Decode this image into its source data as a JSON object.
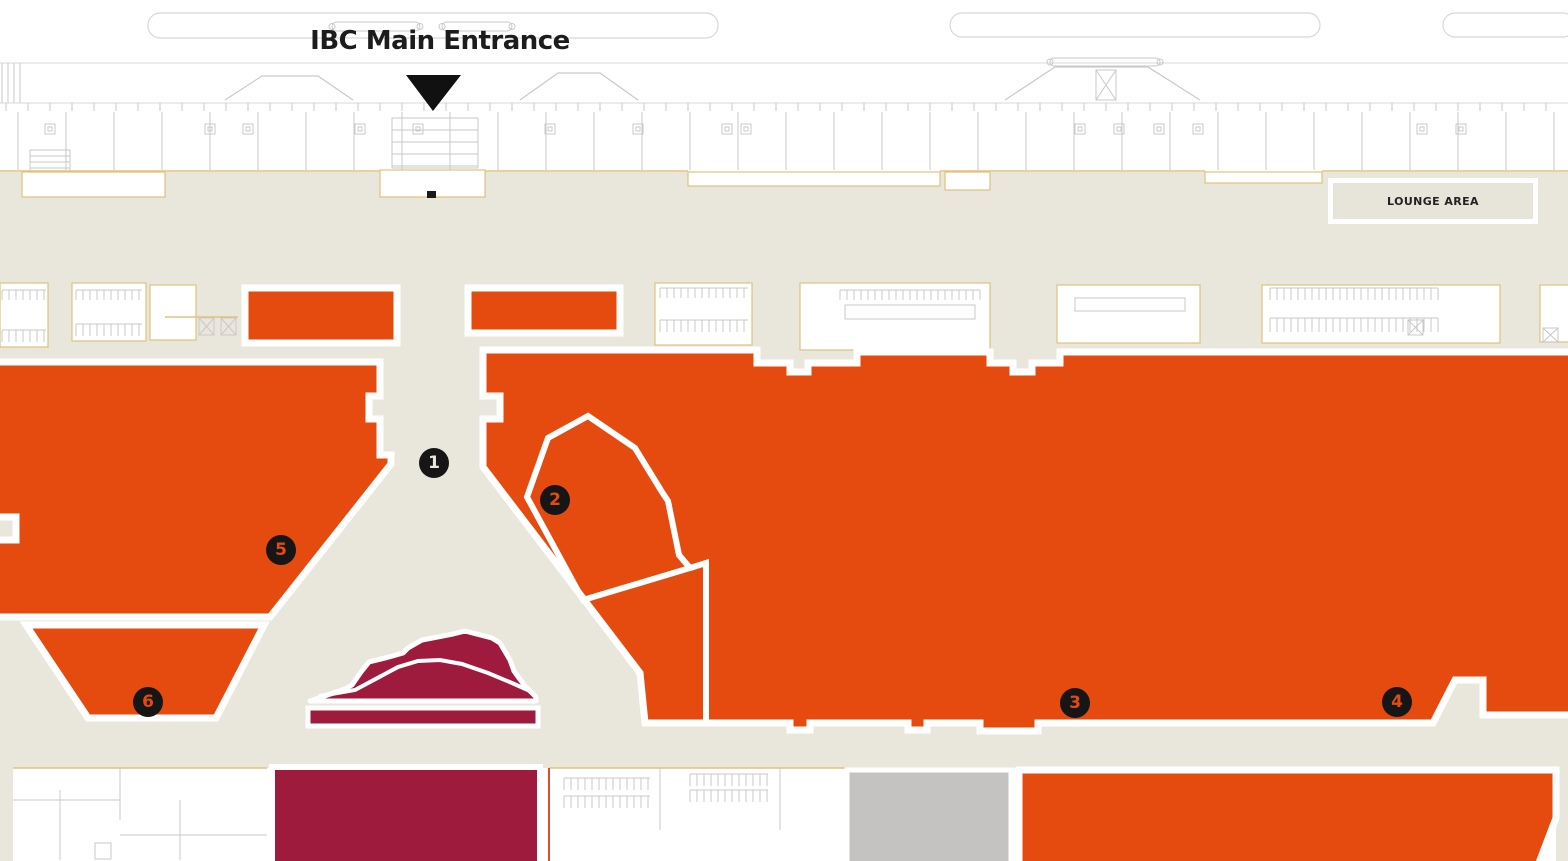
{
  "map": {
    "title_label": "IBC Main Entrance",
    "lounge_label": "LOUNGE AREA",
    "colors": {
      "beige": "#e9e7db",
      "orange": "#e54a0f",
      "maroon": "#9e1b3e",
      "gray": "#c4c3c1",
      "white": "#ffffff",
      "marker_bg": "#161616",
      "line": "#c9c9c9",
      "line_soft": "#d8d8d8",
      "yellow": "#dfc27d",
      "red_accent": "#d8502a",
      "text": "#1c1c1c"
    },
    "markers": [
      {
        "label": "1",
        "x": 434,
        "y": 463,
        "fg": "#e9e7db"
      },
      {
        "label": "2",
        "x": 555,
        "y": 500,
        "fg": "#e54a0f"
      },
      {
        "label": "3",
        "x": 1075,
        "y": 703,
        "fg": "#e54a0f"
      },
      {
        "label": "4",
        "x": 1397,
        "y": 702,
        "fg": "#e54a0f"
      },
      {
        "label": "5",
        "x": 281,
        "y": 550,
        "fg": "#e54a0f"
      },
      {
        "label": "6",
        "x": 148,
        "y": 702,
        "fg": "#e54a0f"
      }
    ],
    "entrance_arrow": {
      "points": [
        [
          406,
          75
        ],
        [
          461,
          75
        ],
        [
          433,
          111
        ]
      ]
    },
    "base": {
      "beige_rect": [
        0,
        172,
        1568,
        696
      ],
      "bottom_white_rect": [
        13,
        768,
        1543,
        100
      ]
    },
    "orange_regions": [
      {
        "name": "booth-block-a",
        "points": [
          [
            245,
            288
          ],
          [
            397,
            288
          ],
          [
            397,
            343
          ],
          [
            245,
            343
          ]
        ]
      },
      {
        "name": "booth-block-b",
        "points": [
          [
            468,
            288
          ],
          [
            620,
            288
          ],
          [
            620,
            333
          ],
          [
            468,
            333
          ]
        ]
      },
      {
        "name": "zone-5",
        "points": [
          [
            -8,
            362
          ],
          [
            380,
            362
          ],
          [
            380,
            396
          ],
          [
            369,
            396
          ],
          [
            369,
            419
          ],
          [
            380,
            419
          ],
          [
            380,
            455
          ],
          [
            391,
            455
          ],
          [
            391,
            464
          ],
          [
            270,
            617
          ],
          [
            -8,
            617
          ],
          [
            -8,
            540
          ],
          [
            16,
            540
          ],
          [
            16,
            517
          ],
          [
            -8,
            517
          ]
        ]
      },
      {
        "name": "zone-6",
        "points": [
          [
            26,
            625
          ],
          [
            264,
            625
          ],
          [
            216,
            718
          ],
          [
            88,
            718
          ]
        ]
      },
      {
        "name": "main-hall",
        "points": [
          [
            483,
            350
          ],
          [
            757,
            350
          ],
          [
            757,
            363
          ],
          [
            790,
            363
          ],
          [
            790,
            372
          ],
          [
            808,
            372
          ],
          [
            808,
            363
          ],
          [
            857,
            363
          ],
          [
            857,
            352
          ],
          [
            990,
            352
          ],
          [
            990,
            363
          ],
          [
            1013,
            363
          ],
          [
            1013,
            372
          ],
          [
            1032,
            372
          ],
          [
            1032,
            363
          ],
          [
            1060,
            363
          ],
          [
            1060,
            352
          ],
          [
            1575,
            352
          ],
          [
            1575,
            715
          ],
          [
            1483,
            715
          ],
          [
            1483,
            680
          ],
          [
            1455,
            680
          ],
          [
            1433,
            723
          ],
          [
            1038,
            723
          ],
          [
            1038,
            731
          ],
          [
            980,
            731
          ],
          [
            980,
            723
          ],
          [
            927,
            723
          ],
          [
            927,
            730
          ],
          [
            908,
            730
          ],
          [
            908,
            723
          ],
          [
            810,
            723
          ],
          [
            810,
            730
          ],
          [
            790,
            730
          ],
          [
            790,
            723
          ],
          [
            645,
            723
          ],
          [
            640,
            673
          ],
          [
            483,
            467
          ],
          [
            483,
            419
          ],
          [
            500,
            419
          ],
          [
            500,
            396
          ],
          [
            483,
            396
          ]
        ]
      },
      {
        "name": "south-hall",
        "points": [
          [
            1019,
            770
          ],
          [
            1556,
            770
          ],
          [
            1556,
            818
          ],
          [
            1537,
            868
          ],
          [
            1019,
            868
          ]
        ]
      }
    ],
    "white_division_lines": [
      {
        "name": "zone-2-outline",
        "closed": true,
        "points": [
          [
            588,
            416
          ],
          [
            635,
            448
          ],
          [
            662,
            492
          ],
          [
            668,
            501
          ],
          [
            679,
            555
          ],
          [
            690,
            568
          ],
          [
            583,
            600
          ],
          [
            527,
            497
          ],
          [
            548,
            438
          ]
        ]
      },
      {
        "name": "hall-divider",
        "closed": false,
        "points": [
          [
            690,
            568
          ],
          [
            706,
            563
          ],
          [
            706,
            723
          ]
        ]
      }
    ],
    "maroon": {
      "mountain": [
        [
          310,
          701
        ],
        [
          345,
          689
        ],
        [
          352,
          685
        ],
        [
          361,
          672
        ],
        [
          369,
          662
        ],
        [
          389,
          657
        ],
        [
          403,
          653
        ],
        [
          408,
          648
        ],
        [
          422,
          640
        ],
        [
          453,
          634
        ],
        [
          465,
          631
        ],
        [
          492,
          638
        ],
        [
          500,
          643
        ],
        [
          510,
          660
        ],
        [
          514,
          671
        ],
        [
          519,
          678
        ],
        [
          525,
          686
        ],
        [
          536,
          697
        ],
        [
          536,
          701
        ]
      ],
      "ridge": [
        [
          320,
          696
        ],
        [
          355,
          690
        ],
        [
          398,
          667
        ],
        [
          418,
          661
        ],
        [
          440,
          660
        ],
        [
          462,
          664
        ],
        [
          488,
          673
        ],
        [
          512,
          683
        ],
        [
          530,
          691
        ]
      ],
      "bar": [
        308,
        708,
        230,
        18
      ],
      "south_block": [
        272,
        767,
        268,
        101
      ]
    },
    "gray_block": [
      847,
      770,
      164,
      98
    ],
    "top_band": {
      "hlines": [
        [
          0,
          63,
          1568,
          63
        ],
        [
          0,
          103,
          1568,
          103
        ]
      ],
      "rounded_rects": [
        [
          148,
          13,
          570,
          25
        ],
        [
          950,
          13,
          370,
          24
        ],
        [
          1443,
          13,
          132,
          24
        ]
      ],
      "capsules": [
        [
          332,
          22,
          88,
          9
        ],
        [
          442,
          22,
          70,
          9
        ],
        [
          1050,
          58,
          110,
          8
        ]
      ],
      "mounds": [
        [
          [
            225,
            100
          ],
          [
            262,
            76
          ],
          [
            318,
            76
          ],
          [
            353,
            100
          ]
        ],
        [
          [
            520,
            100
          ],
          [
            558,
            73
          ],
          [
            600,
            73
          ],
          [
            638,
            100
          ]
        ],
        [
          [
            1005,
            100
          ],
          [
            1055,
            67
          ],
          [
            1148,
            67
          ],
          [
            1200,
            100
          ]
        ]
      ],
      "truss": [
        1096,
        70,
        20,
        30
      ],
      "tick_row": {
        "y": 103,
        "h": 8,
        "step": 22
      },
      "divider_row": {
        "y1": 112,
        "y2": 170,
        "step": 48,
        "x0": 18
      },
      "squares": [
        45,
        205,
        243,
        355,
        413,
        545,
        633,
        722,
        741,
        1075,
        1114,
        1154,
        1193,
        1417,
        1456
      ],
      "stairs": [
        30,
        150,
        40,
        38
      ],
      "shelves": [
        392,
        118,
        86,
        50
      ],
      "left_hatch": [
        2,
        63,
        18,
        40
      ]
    },
    "beige_top_yellow_segments": [
      [
        0,
        380
      ],
      [
        485,
        688
      ],
      [
        940,
        1205
      ],
      [
        1322,
        1568
      ]
    ],
    "cutouts": [
      [
        22,
        172,
        143,
        25
      ],
      [
        380,
        170,
        105,
        27
      ],
      [
        688,
        172,
        252,
        14
      ],
      [
        945,
        172,
        45,
        18
      ],
      [
        1205,
        172,
        117,
        11
      ]
    ],
    "door_tick": [
      427,
      191,
      9,
      7
    ],
    "mid_rooms": [
      [
        0,
        283,
        48,
        64
      ],
      [
        72,
        283,
        74,
        58
      ],
      [
        150,
        285,
        46,
        55
      ],
      [
        655,
        283,
        97,
        62
      ],
      [
        800,
        283,
        190,
        67
      ],
      [
        1057,
        285,
        143,
        58
      ],
      [
        1262,
        285,
        238,
        58
      ],
      [
        1540,
        285,
        34,
        57
      ]
    ],
    "bottom_rooms": [
      [
        13,
        768,
        254,
        100
      ],
      [
        549,
        768,
        296,
        100
      ]
    ],
    "combs": [
      [
        2,
        290,
        44,
        10
      ],
      [
        2,
        330,
        44,
        12
      ],
      [
        76,
        290,
        66,
        10
      ],
      [
        76,
        324,
        66,
        12
      ],
      [
        660,
        288,
        88,
        10
      ],
      [
        660,
        320,
        88,
        12
      ],
      [
        840,
        290,
        140,
        10
      ],
      [
        1270,
        288,
        168,
        12
      ],
      [
        1270,
        318,
        168,
        14
      ],
      [
        564,
        778,
        86,
        12
      ],
      [
        564,
        796,
        86,
        12
      ],
      [
        690,
        774,
        78,
        12
      ],
      [
        690,
        790,
        78,
        12
      ]
    ],
    "counters": [
      [
        845,
        305,
        130,
        14
      ],
      [
        1075,
        298,
        110,
        13
      ]
    ],
    "xboxes": [
      [
        199,
        318,
        15,
        17
      ],
      [
        221,
        318,
        15,
        17
      ],
      [
        1408,
        320,
        15,
        15
      ],
      [
        1543,
        328,
        15,
        14
      ]
    ],
    "yellow_hlines": [
      [
        165,
        317,
        73
      ],
      [
        13,
        768,
        254
      ],
      [
        549,
        768,
        296
      ]
    ],
    "red_vline": [
      549,
      768,
      93
    ],
    "room_lines": [
      [
        60,
        790,
        60,
        860
      ],
      [
        120,
        768,
        120,
        820
      ],
      [
        180,
        800,
        180,
        860
      ],
      [
        13,
        800,
        120,
        800
      ],
      [
        120,
        835,
        267,
        835
      ],
      [
        660,
        768,
        660,
        830
      ],
      [
        780,
        768,
        780,
        830
      ]
    ],
    "door_squares": [
      [
        95,
        843,
        16,
        16
      ],
      [
        400,
        800,
        0,
        0
      ]
    ]
  }
}
